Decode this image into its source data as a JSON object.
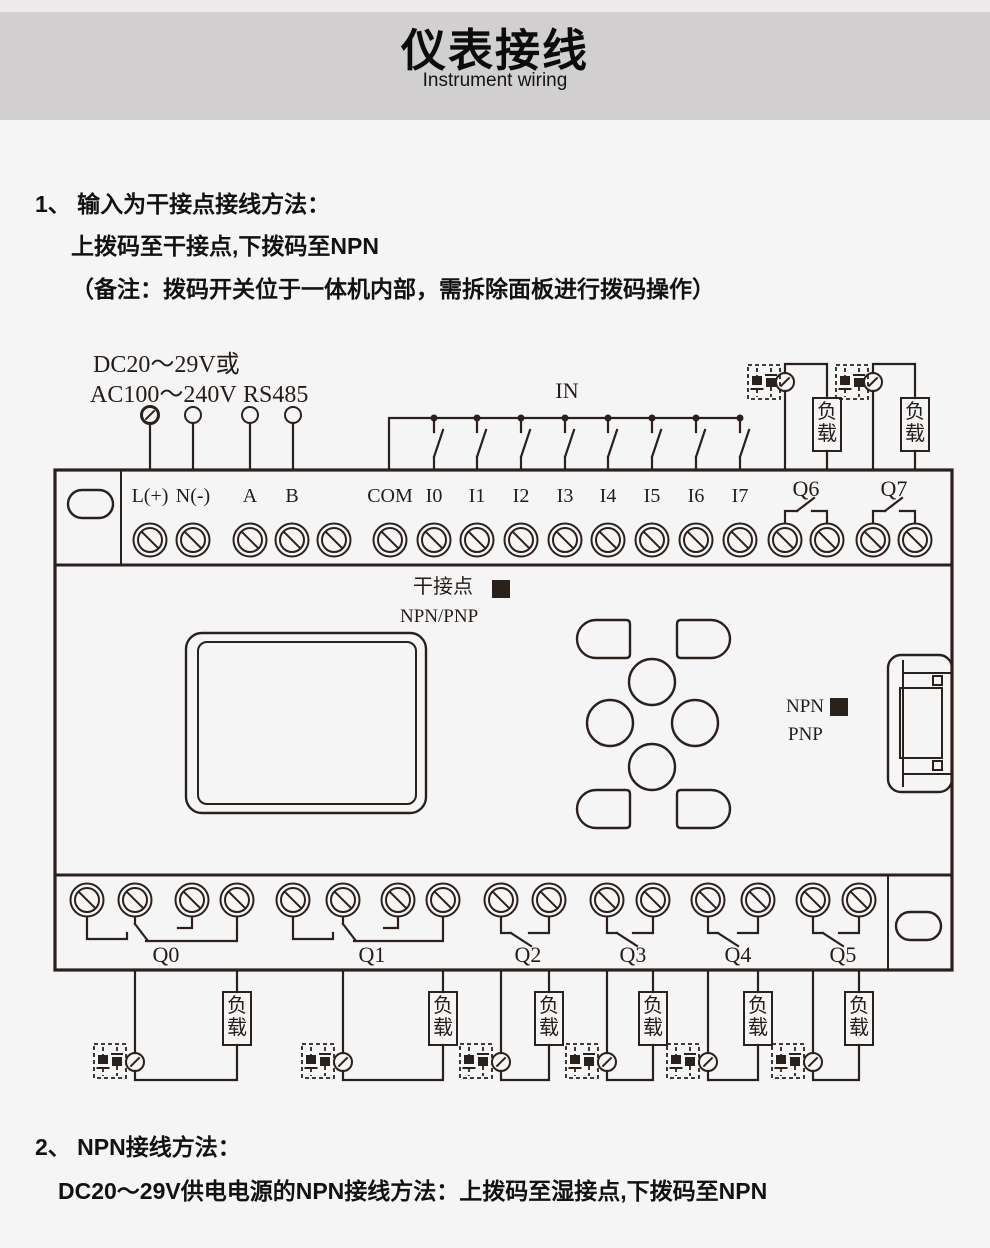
{
  "header": {
    "title": "仪表接线",
    "subtitle": "Instrument wiring"
  },
  "section1": {
    "line1": "1、 输入为干接点接线方法：",
    "line2": "上拨码至干接点,下拨码至NPN",
    "line3": "（备注：拨码开关位于一体机内部，需拆除面板进行拨码操作）"
  },
  "section2": {
    "line1": "2、 NPN接线方法：",
    "line2": "DC20～29V供电电源的NPN接线方法：上拨码至湿接点,下拨码至NPN"
  },
  "diagram": {
    "power_label_line1": "DC20～29V或",
    "power_label_line2": "AC100～240V",
    "rs485_label": "RS485",
    "in_label": "IN",
    "top_terminals": [
      "L(+)",
      "N(-)",
      "A",
      "B",
      "COM",
      "I0",
      "I1",
      "I2",
      "I3",
      "I4",
      "I5",
      "I6",
      "I7"
    ],
    "top_relays": [
      "Q6",
      "Q7"
    ],
    "bottom_relays": [
      "Q0",
      "Q1",
      "Q2",
      "Q3",
      "Q4",
      "Q5"
    ],
    "load_label": "负载",
    "dip_dry_label": "干接点",
    "dip_dry_mode": "NPN/PNP",
    "dip_npn": "NPN",
    "dip_pnp": "PNP",
    "colors": {
      "line": "#2a211d",
      "header_bg": "#d1cfcf",
      "page_bg": "#f6f5f5",
      "text": "#141210"
    }
  }
}
